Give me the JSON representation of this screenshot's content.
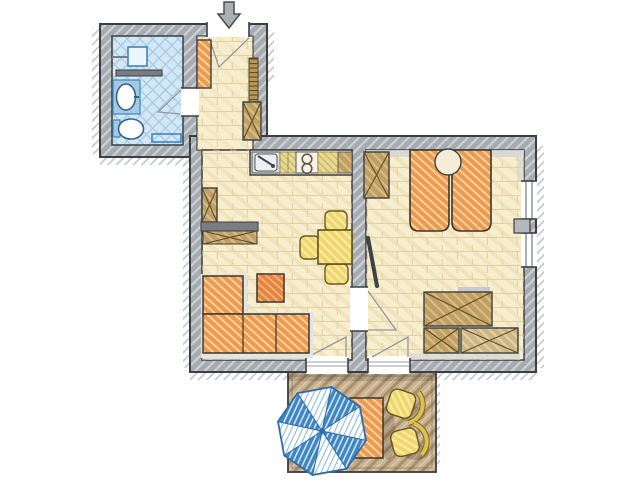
{
  "scene": {
    "kind": "apartment floor plan, hand-drawn color sketch, top-down view",
    "entrance": {
      "icon": "entrance-arrow",
      "direction": "down-into-hallway"
    }
  },
  "rooms": [
    {
      "id": "bathroom",
      "floor": "blue cross-hatch tile",
      "features": [
        "shower-head",
        "wall-shelf",
        "washbasin",
        "toilet",
        "towel-radiator"
      ]
    },
    {
      "id": "hallway",
      "floor": "cream tile",
      "features": [
        "entrance-door",
        "orange-cabinet",
        "slatted-wall-shelf",
        "storage-cabinet"
      ]
    },
    {
      "id": "living-room-kitchen",
      "floor": "cream tile",
      "features": [
        "kitchenette-sink",
        "two-burner-stove",
        "counter",
        "tall-cabinet",
        "sideboard",
        "corner-sofa",
        "ottoman",
        "dining-table",
        "three-chairs",
        "terrace-door"
      ]
    },
    {
      "id": "bedroom",
      "floor": "cream tile",
      "features": [
        "double-bed",
        "round-bedside-table",
        "wardrobe",
        "closet-group",
        "wall-tv",
        "two-windows",
        "terrace-door"
      ]
    },
    {
      "id": "terrace",
      "floor": "tan decking",
      "features": [
        "parasol",
        "outdoor-table",
        "two-garden-chairs"
      ]
    }
  ],
  "colors": {
    "background": "#ffffff",
    "wall_fill": "#a6abb0",
    "wall_hatch": "#cdd1d5",
    "shadow": "#9aa0a5",
    "floor_cream": "#f6eecf",
    "floor_tile_line": "#e2d2a6",
    "floor_warm_hatch": "#ecd6a0",
    "ledge_gray": "#d3d6d8",
    "bath_floor": "#d3e7f4",
    "bath_hatch": "#a4c9e4",
    "fixture_blue": "#3e86c0",
    "fixture_fill": "#eef5fb",
    "slate": "#787d82",
    "steel": "#d7dbde",
    "steel_light": "#edf0f1",
    "stove_fill": "#f6f2e4",
    "counter_base": "#f0e9cf",
    "counter": "#ead892",
    "counter_hatch": "#cbbd6e",
    "orange": "#ec9a4b",
    "orange_hatch": "#f8d2a8",
    "orange_dark": "#e5853b",
    "orange_dark_hatch": "#f2b98a",
    "yellow": "#f2d768",
    "yellow_hatch": "#f9ecb4",
    "yellow_back": "#dfbf4e",
    "wood": "#c19f63",
    "wood_hatch": "#d6bd85",
    "wood_light": "#cdb684",
    "wood_light_hatch": "#e0d0a8",
    "wood_rung": "#b99753",
    "wood_rung_line": "#5f4f28",
    "sofa_base": "#e2e4e5",
    "terrace_floor": "#c8b292",
    "terrace_hatch": "#a98f6c",
    "terrace_hatch_light": "#dbc9a6",
    "parasol_blue": "#3f86c5",
    "parasol_stripe": "#8db9de",
    "parasol_ink": "#2f6da8",
    "round_table_fill": "#f4edda",
    "tv_dark": "#3f4347",
    "pier_gray": "#b3b8bc",
    "bar_gray": "#c8ccce",
    "arrow_fill": "#aaafb4"
  }
}
